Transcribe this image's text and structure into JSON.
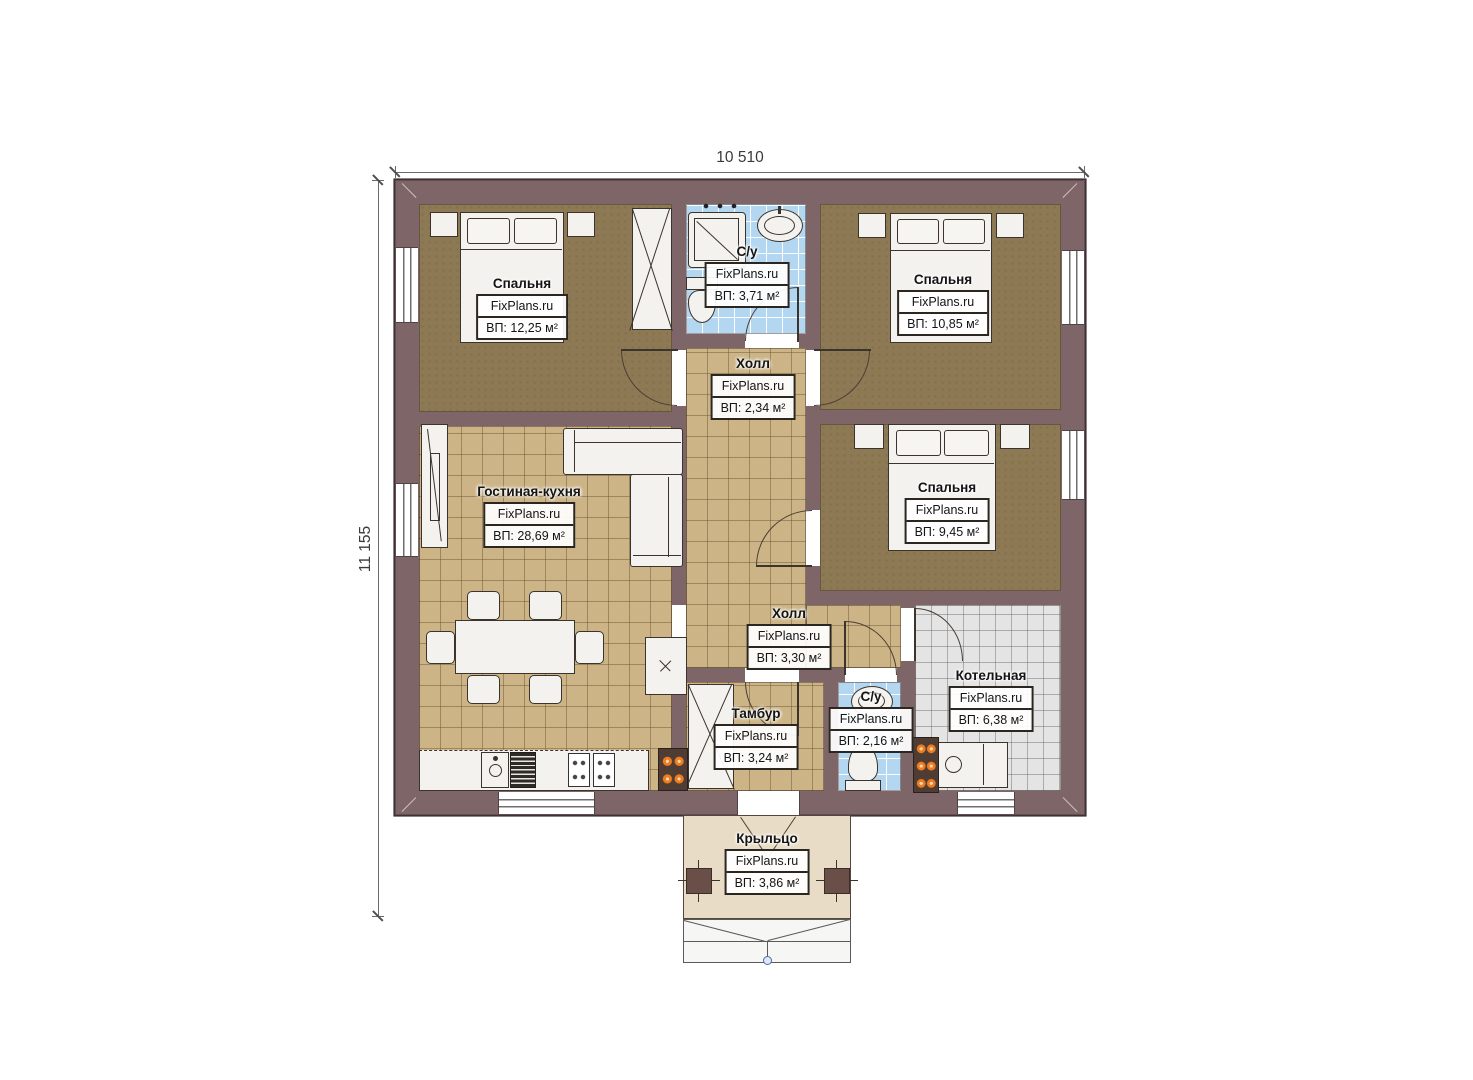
{
  "title": "Одноэтажный дом — план этажа",
  "brand": "FixPlans.ru",
  "dimensions": {
    "width_label": "10 510",
    "height_label": "11 155"
  },
  "rooms": {
    "bedroom1": {
      "name": "Спальня",
      "area": "ВП: 12,25 м²"
    },
    "bath_top": {
      "name": "С/у",
      "area": "ВП: 3,71 м²"
    },
    "bedroom2": {
      "name": "Спальня",
      "area": "ВП: 10,85 м²"
    },
    "hall_top": {
      "name": "Холл",
      "area": "ВП: 2,34 м²"
    },
    "living": {
      "name": "Гостиная-кухня",
      "area": "ВП: 28,69 м²"
    },
    "bedroom3": {
      "name": "Спальня",
      "area": "ВП: 9,45 м²"
    },
    "hall_low": {
      "name": "Холл",
      "area": "ВП: 3,30 м²"
    },
    "tambur": {
      "name": "Тамбур",
      "area": "ВП: 3,24 м²"
    },
    "bath_low": {
      "name": "С/у",
      "area": "ВП: 2,16 м²"
    },
    "boiler": {
      "name": "Котельная",
      "area": "ВП: 6,38 м²"
    },
    "porch": {
      "name": "Крыльцо",
      "area": "ВП: 3,86 м²"
    }
  },
  "colors": {
    "wall": "#7e6568",
    "floor_wood_dark": "#8d7954",
    "floor_tile_tan": "#ccb487",
    "floor_tile_blue": "#b4d7f1",
    "floor_tile_gray": "#e4e4e4",
    "porch_floor": "#e8dcc6",
    "furniture": "#f3f2ef",
    "flame_orange": "#f07c20",
    "step_marker_blue": "#4a6fa5"
  }
}
